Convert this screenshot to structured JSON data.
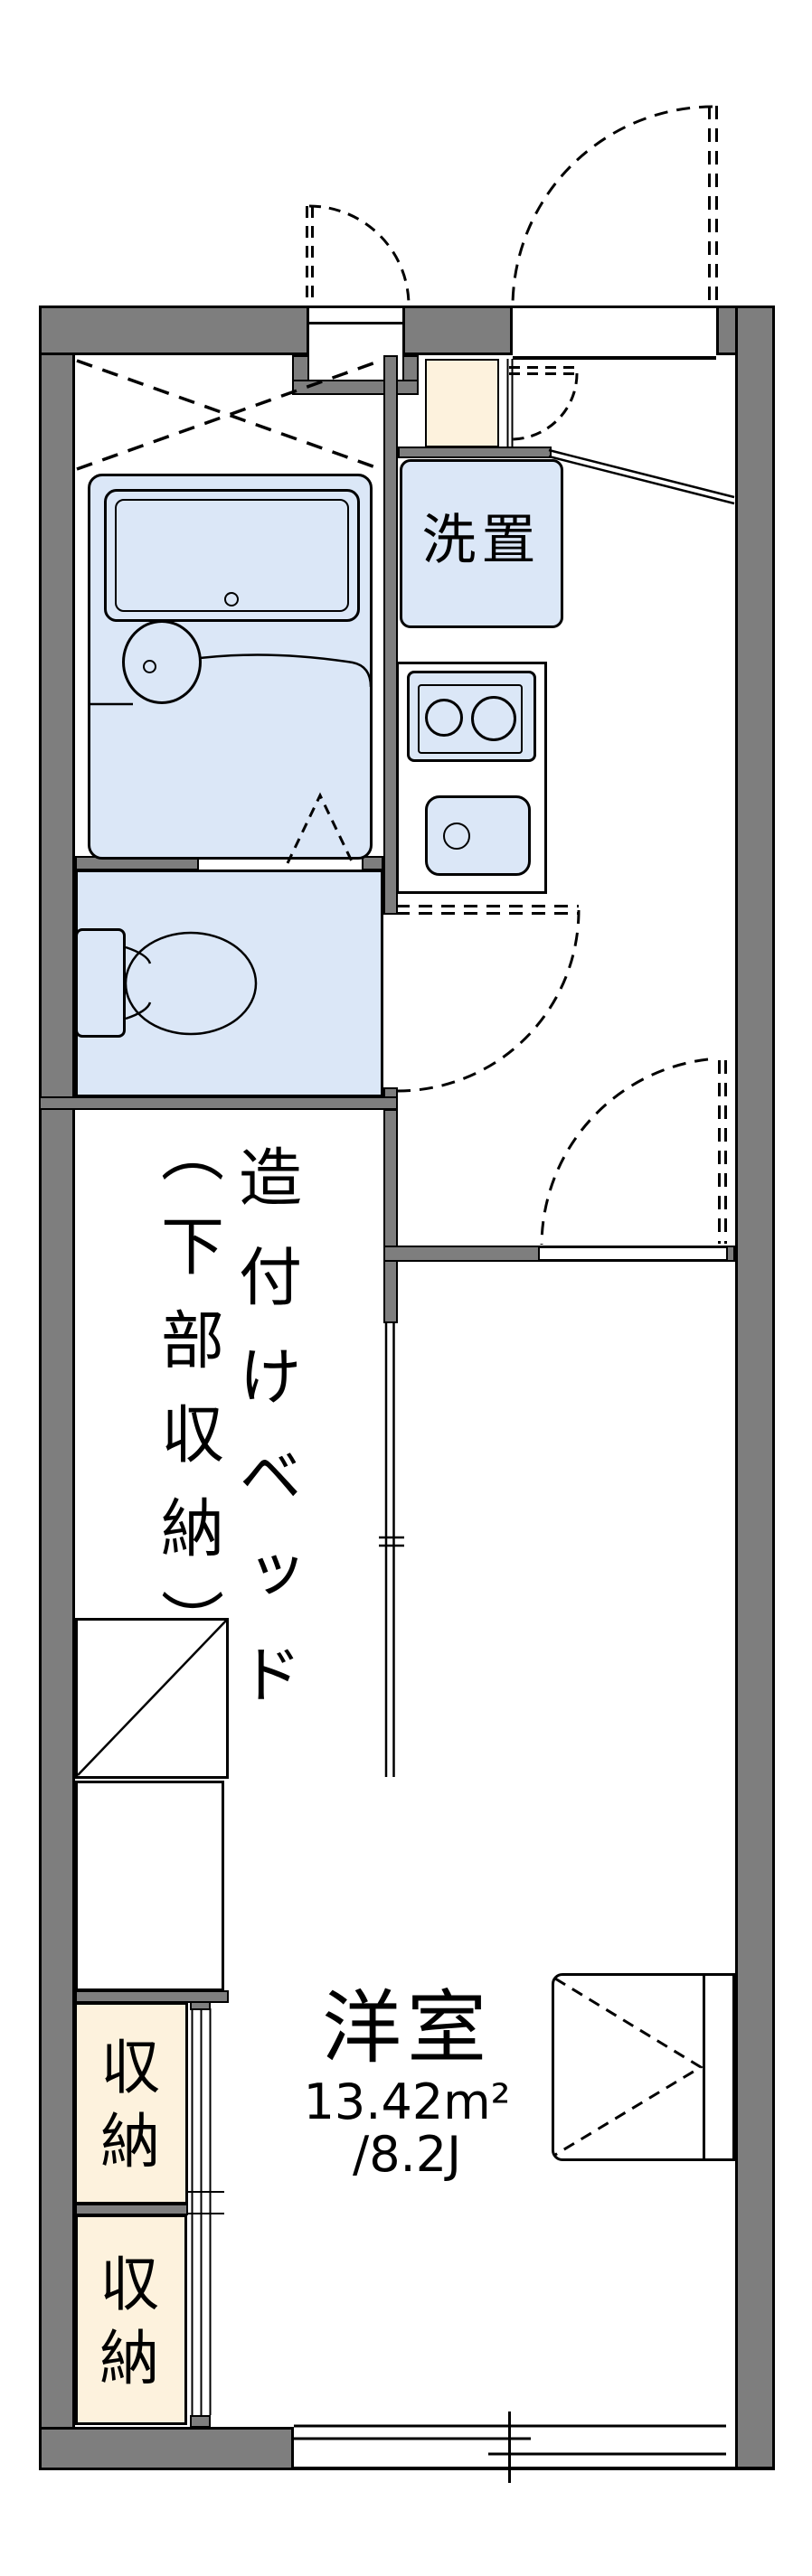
{
  "plan": {
    "type": "apartment-floorplan",
    "colors": {
      "wall": "#7e7e7e",
      "fixture_fill": "#dbe7f7",
      "storage_fill": "#fdf2dd",
      "line": "#000000",
      "background": "#ffffff"
    },
    "labels": {
      "washer": "洗置",
      "bed_col1": "造付けベッド",
      "bed_col2": "（下部収納）",
      "storage_upper": "収納",
      "storage_lower": "収納",
      "room_name": "洋室",
      "room_area": "13.42m²",
      "room_tatami": "/8.2J"
    }
  }
}
